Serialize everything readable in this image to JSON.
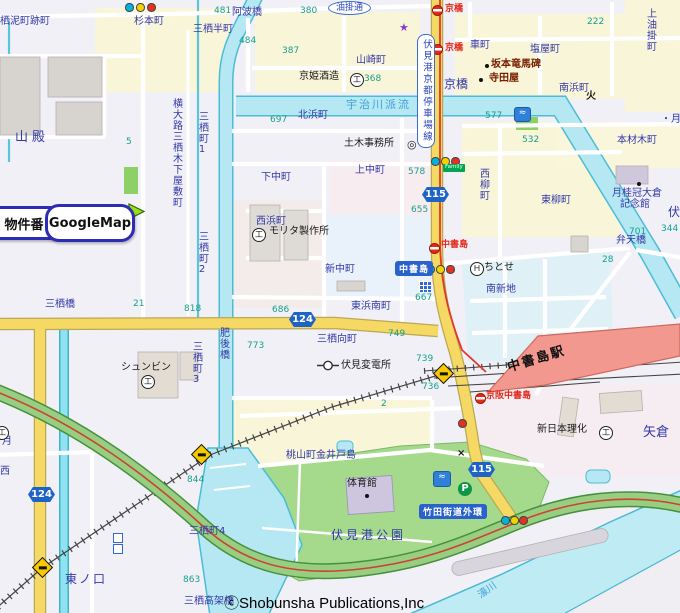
{
  "buttons": {
    "property": "物件番",
    "googlemap": "GoogleMap"
  },
  "copyright": "ⓒShobunsha Publications,Inc",
  "roads": {
    "r115": "115",
    "r124": "124",
    "chushojima_sign": "中書島",
    "takeda_kaido": "竹田街道外環",
    "fushimiko_line": "伏見港京都停車場線",
    "aburakake_dori": "油掛通"
  },
  "station": {
    "chushojima_eki": "中書島駅"
  },
  "transit": {
    "kyobashi_stop": "京橋",
    "chushojima_stop": "中書島",
    "keihan_chushojima_stop": "京阪中書島"
  },
  "districts": {
    "sudorocho": "栖泥町跡町",
    "sugimotocho": "杉本町",
    "misuhancho": "三栖半町",
    "yamadono": "山殿",
    "yokoojimisu": "横大路三栖木下屋敷町",
    "misucho1": "三栖町1",
    "misucho2": "三栖町2",
    "misucho3": "三栖町3",
    "misucho4": "三栖町4",
    "higashinokuchi": "東ノ口",
    "shimonakacho": "下中町",
    "kaminakacho": "上中町",
    "kitahamacho": "北浜町",
    "nishihamacho": "西浜町",
    "shinnakacho": "新中町",
    "higashihamaminamicho": "東浜南町",
    "misumukaicho": "三栖向町",
    "yamazakicho": "山崎町",
    "momoyamacho": "桃山町金井戸島",
    "kurumamachi": "車町",
    "shioyacho": "塩屋町",
    "minamihamacho": "南浜町",
    "kamiaburakakecho": "上油掛町",
    "honzaimokucho": "本材木町",
    "higashiyanagicho": "東柳町",
    "nishiyanagicho": "西柳町",
    "minamishinchi": "南新地",
    "yagura": "矢倉",
    "tsuki_partial": "・月",
    "fushi_partial": "伏",
    "tsuki2": "月",
    "nishi_partial": "西"
  },
  "bridges": {
    "awabashi": "阿波橋",
    "misubashi": "三栖橋",
    "higobashi": "肥後橋",
    "bentenbashi": "弁天橋",
    "kyobashi": "京橋",
    "misukokakyo": "三栖高架橋"
  },
  "pois": {
    "kyohime": "京姫酒造",
    "morita": "モリタ製作所",
    "doboku": "土木事務所",
    "sakamoto": "坂本竜馬碑",
    "teradaya": "寺田屋",
    "chitose": "ちとせ",
    "hendensho": "伏見変電所",
    "shunbin": "シュンビン",
    "shinnihonrika": "新日本理化",
    "gekkeikan1": "月桂冠大倉",
    "gekkeikan2": "記念館",
    "taiikukan": "体育館",
    "fushimiko_koen": "伏見港公園"
  },
  "waterways": {
    "ujigawa_haryu": "宇治川派流",
    "horikawa": "濠川"
  },
  "numbers": {
    "n481": "481",
    "n380": "380",
    "n484": "484",
    "n387": "387",
    "n368": "368",
    "n697": "697",
    "n222": "222",
    "n577": "577",
    "n532": "532",
    "n578": "578",
    "n655": "655",
    "n667": "667",
    "n686": "686",
    "n21": "21",
    "n818": "818",
    "n749": "749",
    "n739": "739",
    "n736": "736",
    "n773": "773",
    "n2": "2",
    "n5": "5",
    "n701": "701",
    "n344": "344",
    "n28": "28",
    "n844": "844",
    "n863": "863"
  },
  "icons": {
    "hotel": "Ｈ",
    "factory": "工",
    "parking": "P",
    "fire": "火",
    "police": "×",
    "star": "★",
    "family": "Family",
    "pool": "≈",
    "govt": "◎"
  },
  "colors": {
    "road_yellow": "#f6d964",
    "park_green": "#a5d98c",
    "water": "#b6e8f3",
    "station_pink": "#f2988e",
    "sign_blue": "#2a62cc",
    "elevated_green": "#98ce82"
  }
}
